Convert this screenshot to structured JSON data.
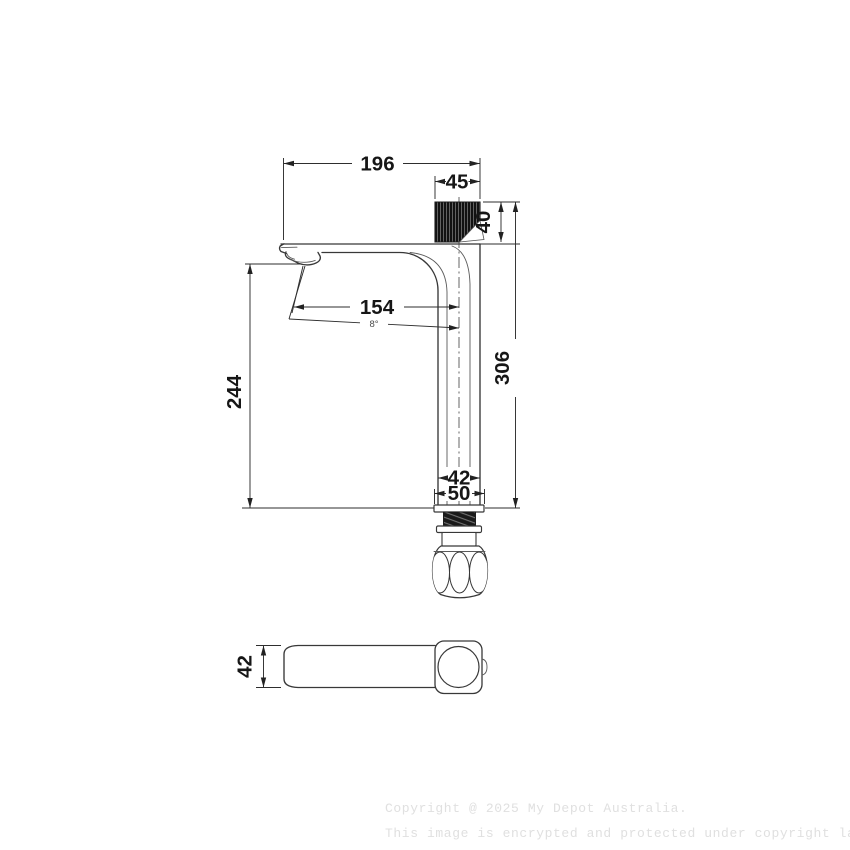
{
  "drawing": {
    "type": "faucet-technical-drawing",
    "views": {
      "front_view": "tall basin mixer tap, side elevation",
      "bottom_view": "spout plan view"
    },
    "dimensions": {
      "overall_reach": "196",
      "handle_width": "45",
      "handle_height": "40",
      "spout_reach": "154",
      "spout_angle": "8°",
      "outlet_height": "244",
      "overall_height": "306",
      "body_width": "42",
      "base_width": "50",
      "spout_depth": "42"
    },
    "watermark": {
      "line1": "Copyright @ 2025 My Depot Australia.",
      "line2": "This image is encrypted and protected under copyright law."
    },
    "colors": {
      "background": "#ffffff",
      "line": "#383838",
      "dimension_line": "#2e2e2e",
      "text": "#161616",
      "handle_fill": "#121212",
      "watermark": "#e0e0e0"
    }
  }
}
